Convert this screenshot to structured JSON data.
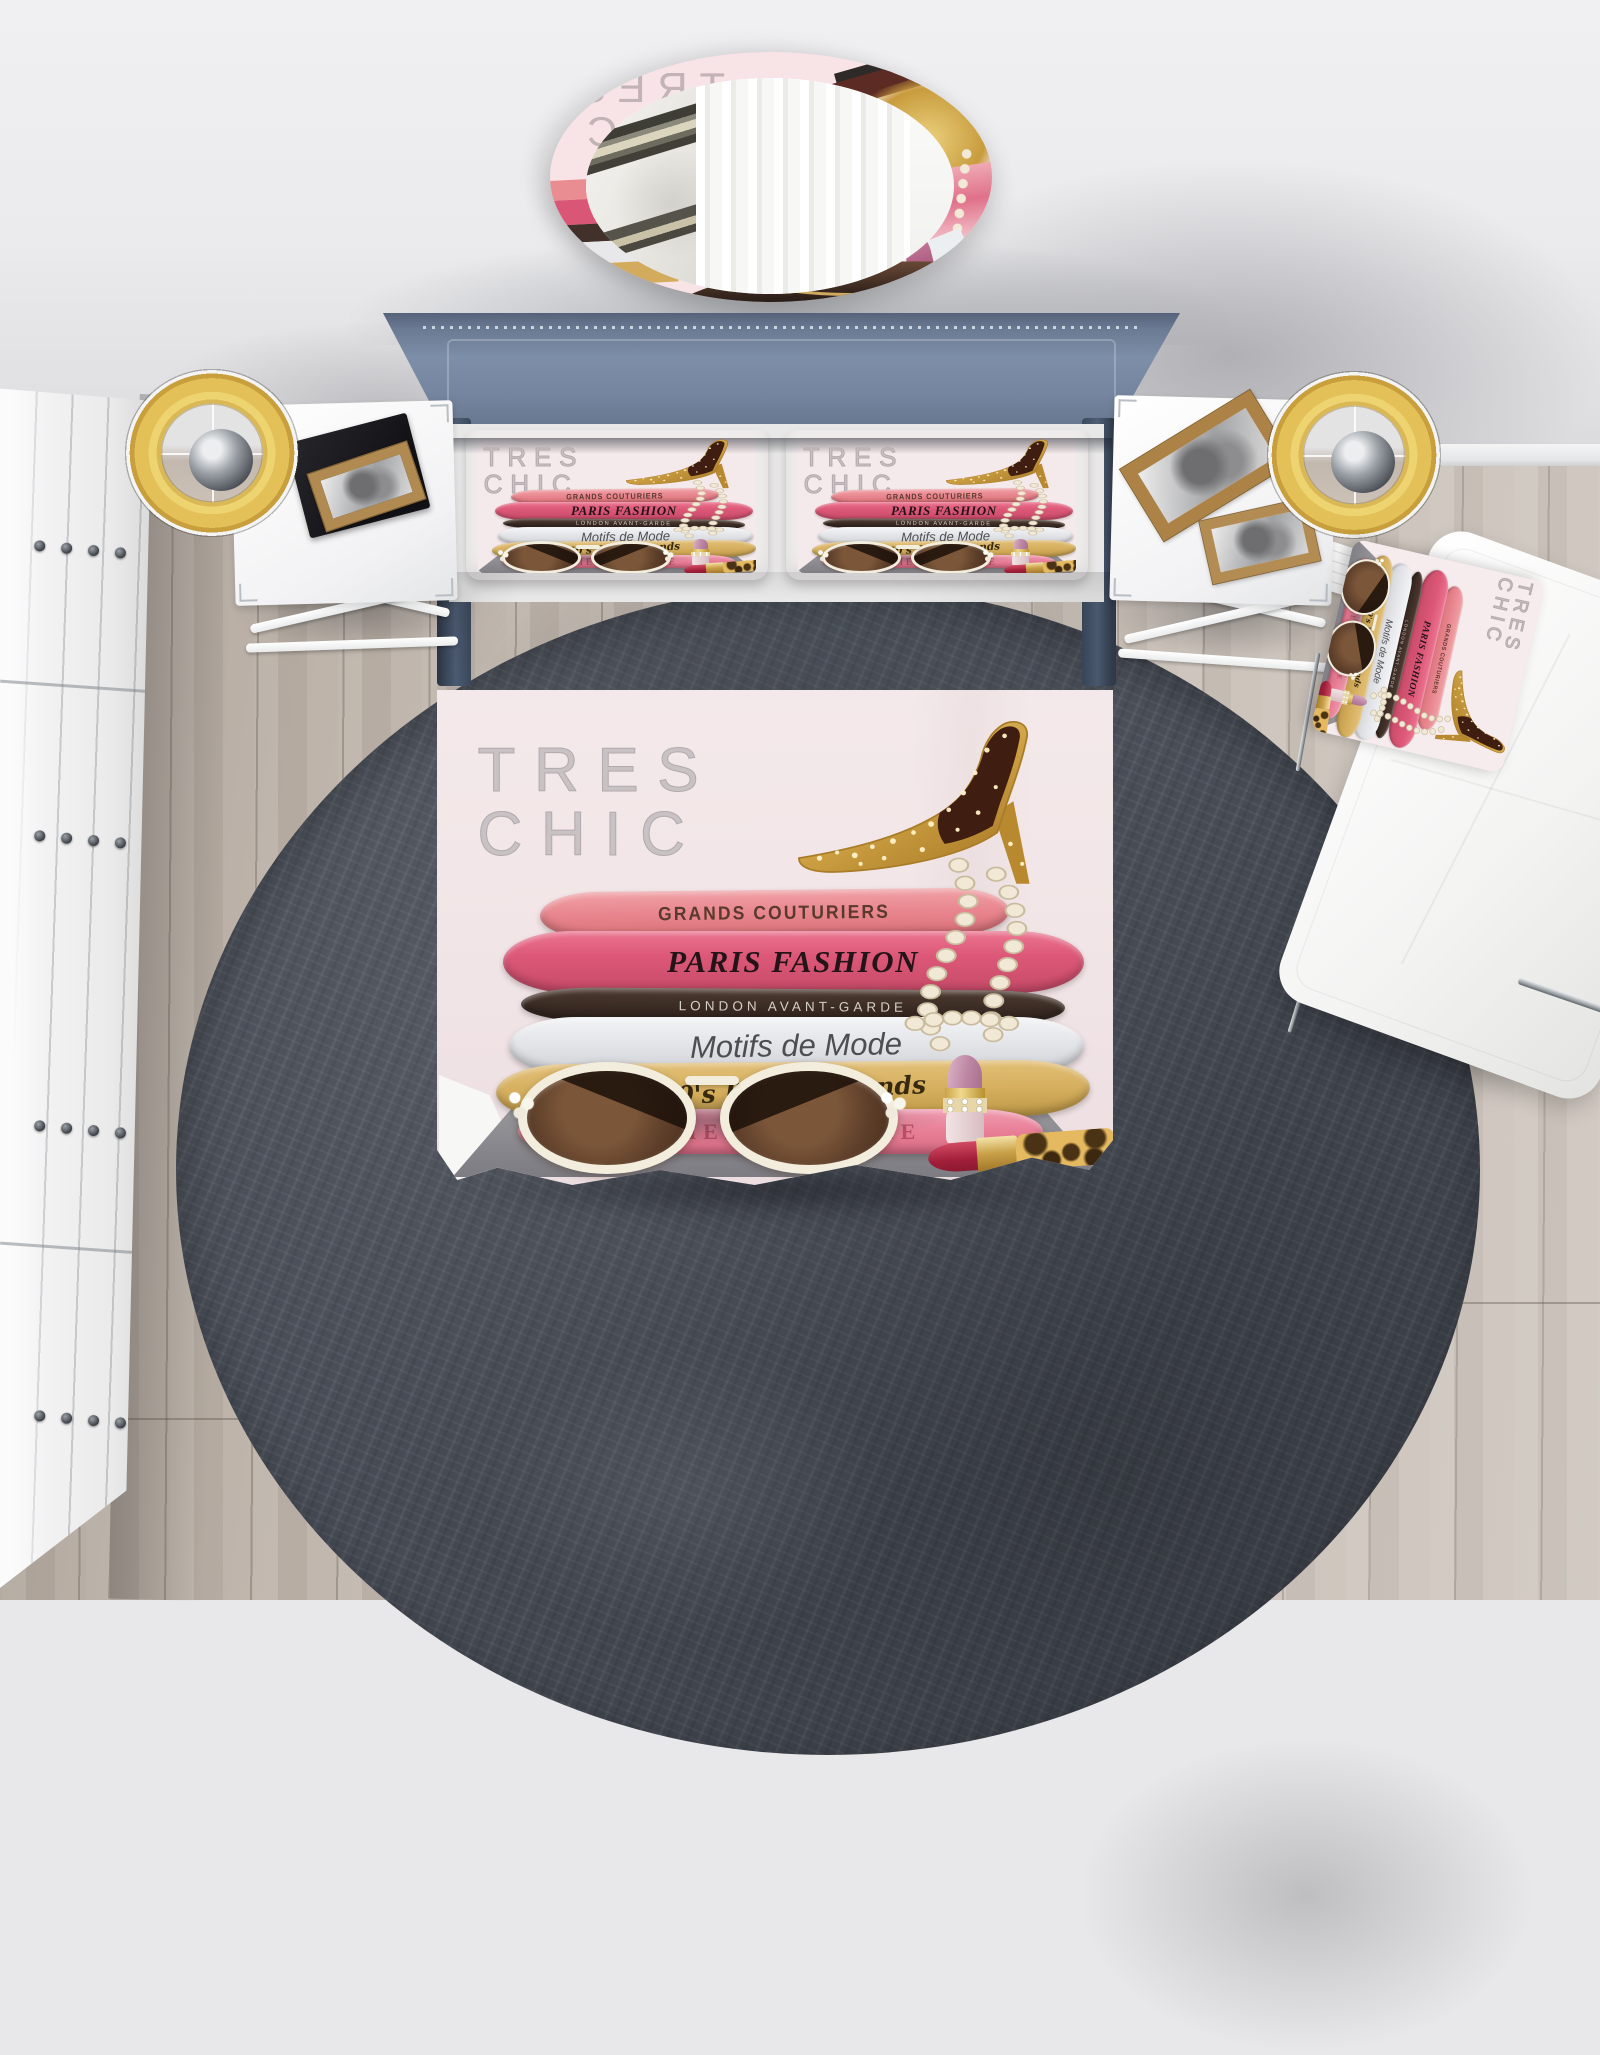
{
  "artwork": {
    "title_line1": "TRES",
    "title_line2": "CHIC",
    "books": [
      {
        "title": "GRANDS COUTURIERS"
      },
      {
        "title": "PARIS FASHION"
      },
      {
        "title": "LONDON AVANT-GARDE"
      },
      {
        "title": "Motifs de Mode"
      },
      {
        "title": "50's Beauty Trends"
      },
      {
        "title": "TIMELESS STYLE"
      }
    ]
  },
  "palette": {
    "wall": "#ebebed",
    "floor_wood": "#c3b9af",
    "rug": "#474c56",
    "headboard_blue": "#7d8ea8",
    "bed_frame": "#3a485c",
    "duvet_background": "#f3e7e9",
    "sheet_white": "#fbfbfb",
    "lamp_shade_gold": "#e3c158",
    "book_salmon": "#e98790",
    "book_magenta": "#dd5878",
    "book_brown": "#3a2b24",
    "book_white": "#e4e5e9",
    "book_gold": "#d5af5e",
    "book_pink": "#e87f97",
    "shoe_gold": "#cfa245",
    "lipstick_red": "#a21f3a",
    "lipstick_pink": "#bd87a4",
    "pearl": "#f1e9d6"
  }
}
